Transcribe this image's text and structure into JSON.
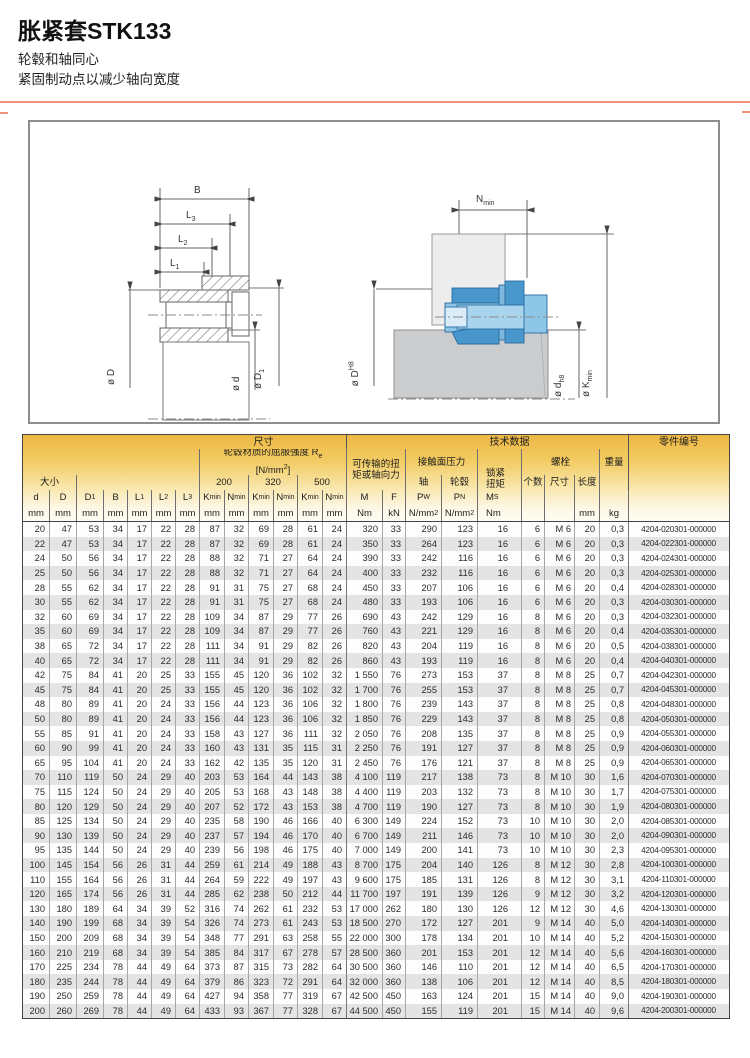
{
  "page": {
    "title": "胀紧套STK133",
    "subtitle_line1": "轮毂和轴同心",
    "subtitle_line2": "紧固制动点以减少轴向宽度",
    "accent_color": "#f0917c"
  },
  "diagram": {
    "left_labels": {
      "b": "B",
      "l3": "L_{3}",
      "l2": "L_{2}",
      "l1": "L_{1}",
      "dia_d_outer": "ø D",
      "dia_d_inner": "ø d",
      "dia_d1": "ø D_{1}"
    },
    "right_labels": {
      "n_min": "N_{min}",
      "dia_dh8_hub": "ø D^{H8}",
      "dia_dh8_shaft": "ø d_{h8}",
      "dia_kmin": "ø K_{min}"
    }
  },
  "table": {
    "sections": {
      "size": "尺寸",
      "tech": "技术数据",
      "part_no": "零件编号"
    },
    "groups": {
      "size_label": "大小",
      "yield_title": "轮毂材质的屈服强度 R_{e}",
      "yield_unit": "[N/mm^{2}]",
      "yield_200": "200",
      "yield_320": "320",
      "yield_500": "500",
      "torque_line1": "可传输的扭",
      "torque_line2": "矩或轴向力",
      "pressure": "接触面压力",
      "pressure_shaft": "轴",
      "pressure_hub": "轮毂",
      "locking_line1": "锁紧",
      "locking_line2": "扭矩",
      "bolts": "螺栓",
      "bolt_count": "个数",
      "bolt_size": "尺寸",
      "bolt_length": "长度",
      "weight": "重量"
    },
    "symbols": [
      "d",
      "D",
      "D_{1}",
      "B",
      "L_{1}",
      "L_{2}",
      "L_{3}",
      "K_{min}",
      "N_{min}",
      "K_{min}",
      "N_{min}",
      "K_{min}",
      "N_{min}",
      "M",
      "F",
      "P_{W}",
      "P_{N}",
      "M_{S}",
      "",
      "",
      "",
      "",
      ""
    ],
    "units": [
      "mm",
      "mm",
      "mm",
      "mm",
      "mm",
      "mm",
      "mm",
      "mm",
      "mm",
      "mm",
      "mm",
      "mm",
      "mm",
      "Nm",
      "kN",
      "N/mm^{2}",
      "N/mm^{2}",
      "Nm",
      "",
      "",
      "mm",
      "kg",
      ""
    ],
    "rows": [
      [
        "20",
        "47",
        "53",
        "34",
        "17",
        "22",
        "28",
        "87",
        "32",
        "69",
        "28",
        "61",
        "24",
        "320",
        "33",
        "290",
        "123",
        "16",
        "6",
        "M 6",
        "20",
        "0,3",
        "4204-020301-000000"
      ],
      [
        "22",
        "47",
        "53",
        "34",
        "17",
        "22",
        "28",
        "87",
        "32",
        "69",
        "28",
        "61",
        "24",
        "350",
        "33",
        "264",
        "123",
        "16",
        "6",
        "M 6",
        "20",
        "0,3",
        "4204-022301-000000"
      ],
      [
        "24",
        "50",
        "56",
        "34",
        "17",
        "22",
        "28",
        "88",
        "32",
        "71",
        "27",
        "64",
        "24",
        "390",
        "33",
        "242",
        "116",
        "16",
        "6",
        "M 6",
        "20",
        "0,3",
        "4204-024301-000000"
      ],
      [
        "25",
        "50",
        "56",
        "34",
        "17",
        "22",
        "28",
        "88",
        "32",
        "71",
        "27",
        "64",
        "24",
        "400",
        "33",
        "232",
        "116",
        "16",
        "6",
        "M 6",
        "20",
        "0,3",
        "4204-025301-000000"
      ],
      [
        "28",
        "55",
        "62",
        "34",
        "17",
        "22",
        "28",
        "91",
        "31",
        "75",
        "27",
        "68",
        "24",
        "450",
        "33",
        "207",
        "106",
        "16",
        "6",
        "M 6",
        "20",
        "0,4",
        "4204-028301-000000"
      ],
      [
        "30",
        "55",
        "62",
        "34",
        "17",
        "22",
        "28",
        "91",
        "31",
        "75",
        "27",
        "68",
        "24",
        "480",
        "33",
        "193",
        "106",
        "16",
        "6",
        "M 6",
        "20",
        "0,3",
        "4204-030301-000000"
      ],
      [
        "32",
        "60",
        "69",
        "34",
        "17",
        "22",
        "28",
        "109",
        "34",
        "87",
        "29",
        "77",
        "26",
        "690",
        "43",
        "242",
        "129",
        "16",
        "8",
        "M 6",
        "20",
        "0,3",
        "4204-032301-000000"
      ],
      [
        "35",
        "60",
        "69",
        "34",
        "17",
        "22",
        "28",
        "109",
        "34",
        "87",
        "29",
        "77",
        "26",
        "760",
        "43",
        "221",
        "129",
        "16",
        "8",
        "M 6",
        "20",
        "0,4",
        "4204-035301-000000"
      ],
      [
        "38",
        "65",
        "72",
        "34",
        "17",
        "22",
        "28",
        "111",
        "34",
        "91",
        "29",
        "82",
        "26",
        "820",
        "43",
        "204",
        "119",
        "16",
        "8",
        "M 6",
        "20",
        "0,5",
        "4204-038301-000000"
      ],
      [
        "40",
        "65",
        "72",
        "34",
        "17",
        "22",
        "28",
        "111",
        "34",
        "91",
        "29",
        "82",
        "26",
        "860",
        "43",
        "193",
        "119",
        "16",
        "8",
        "M 6",
        "20",
        "0,4",
        "4204-040301-000000"
      ],
      [
        "42",
        "75",
        "84",
        "41",
        "20",
        "25",
        "33",
        "155",
        "45",
        "120",
        "36",
        "102",
        "32",
        "1 550",
        "76",
        "273",
        "153",
        "37",
        "8",
        "M 8",
        "25",
        "0,7",
        "4204-042301-000000"
      ],
      [
        "45",
        "75",
        "84",
        "41",
        "20",
        "25",
        "33",
        "155",
        "45",
        "120",
        "36",
        "102",
        "32",
        "1 700",
        "76",
        "255",
        "153",
        "37",
        "8",
        "M 8",
        "25",
        "0,7",
        "4204-045301-000000"
      ],
      [
        "48",
        "80",
        "89",
        "41",
        "20",
        "24",
        "33",
        "156",
        "44",
        "123",
        "36",
        "106",
        "32",
        "1 800",
        "76",
        "239",
        "143",
        "37",
        "8",
        "M 8",
        "25",
        "0,8",
        "4204-048301-000000"
      ],
      [
        "50",
        "80",
        "89",
        "41",
        "20",
        "24",
        "33",
        "156",
        "44",
        "123",
        "36",
        "106",
        "32",
        "1 850",
        "76",
        "229",
        "143",
        "37",
        "8",
        "M 8",
        "25",
        "0,8",
        "4204-050301-000000"
      ],
      [
        "55",
        "85",
        "91",
        "41",
        "20",
        "24",
        "33",
        "158",
        "43",
        "127",
        "36",
        "111",
        "32",
        "2 050",
        "76",
        "208",
        "135",
        "37",
        "8",
        "M 8",
        "25",
        "0,9",
        "4204-055301-000000"
      ],
      [
        "60",
        "90",
        "99",
        "41",
        "20",
        "24",
        "33",
        "160",
        "43",
        "131",
        "35",
        "115",
        "31",
        "2 250",
        "76",
        "191",
        "127",
        "37",
        "8",
        "M 8",
        "25",
        "0,9",
        "4204-060301-000000"
      ],
      [
        "65",
        "95",
        "104",
        "41",
        "20",
        "24",
        "33",
        "162",
        "42",
        "135",
        "35",
        "120",
        "31",
        "2 450",
        "76",
        "176",
        "121",
        "37",
        "8",
        "M 8",
        "25",
        "0,9",
        "4204-065301-000000"
      ],
      [
        "70",
        "110",
        "119",
        "50",
        "24",
        "29",
        "40",
        "203",
        "53",
        "164",
        "44",
        "143",
        "38",
        "4 100",
        "119",
        "217",
        "138",
        "73",
        "8",
        "M 10",
        "30",
        "1,6",
        "4204-070301-000000"
      ],
      [
        "75",
        "115",
        "124",
        "50",
        "24",
        "29",
        "40",
        "205",
        "53",
        "168",
        "43",
        "148",
        "38",
        "4 400",
        "119",
        "203",
        "132",
        "73",
        "8",
        "M 10",
        "30",
        "1,7",
        "4204-075301-000000"
      ],
      [
        "80",
        "120",
        "129",
        "50",
        "24",
        "29",
        "40",
        "207",
        "52",
        "172",
        "43",
        "153",
        "38",
        "4 700",
        "119",
        "190",
        "127",
        "73",
        "8",
        "M 10",
        "30",
        "1,9",
        "4204-080301-000000"
      ],
      [
        "85",
        "125",
        "134",
        "50",
        "24",
        "29",
        "40",
        "235",
        "58",
        "190",
        "46",
        "166",
        "40",
        "6 300",
        "149",
        "224",
        "152",
        "73",
        "10",
        "M 10",
        "30",
        "2,0",
        "4204-085301-000000"
      ],
      [
        "90",
        "130",
        "139",
        "50",
        "24",
        "29",
        "40",
        "237",
        "57",
        "194",
        "46",
        "170",
        "40",
        "6 700",
        "149",
        "211",
        "146",
        "73",
        "10",
        "M 10",
        "30",
        "2,0",
        "4204-090301-000000"
      ],
      [
        "95",
        "135",
        "144",
        "50",
        "24",
        "29",
        "40",
        "239",
        "56",
        "198",
        "46",
        "175",
        "40",
        "7 000",
        "149",
        "200",
        "141",
        "73",
        "10",
        "M 10",
        "30",
        "2,3",
        "4204-095301-000000"
      ],
      [
        "100",
        "145",
        "154",
        "56",
        "26",
        "31",
        "44",
        "259",
        "61",
        "214",
        "49",
        "188",
        "43",
        "8 700",
        "175",
        "204",
        "140",
        "126",
        "8",
        "M 12",
        "30",
        "2,8",
        "4204-100301-000000"
      ],
      [
        "110",
        "155",
        "164",
        "56",
        "26",
        "31",
        "44",
        "264",
        "59",
        "222",
        "49",
        "197",
        "43",
        "9 600",
        "175",
        "185",
        "131",
        "126",
        "8",
        "M 12",
        "30",
        "3,1",
        "4204-110301-000000"
      ],
      [
        "120",
        "165",
        "174",
        "56",
        "26",
        "31",
        "44",
        "285",
        "62",
        "238",
        "50",
        "212",
        "44",
        "11 700",
        "197",
        "191",
        "139",
        "126",
        "9",
        "M 12",
        "30",
        "3,2",
        "4204-120301-000000"
      ],
      [
        "130",
        "180",
        "189",
        "64",
        "34",
        "39",
        "52",
        "316",
        "74",
        "262",
        "61",
        "232",
        "53",
        "17 000",
        "262",
        "180",
        "130",
        "126",
        "12",
        "M 12",
        "30",
        "4,6",
        "4204-130301-000000"
      ],
      [
        "140",
        "190",
        "199",
        "68",
        "34",
        "39",
        "54",
        "326",
        "74",
        "273",
        "61",
        "243",
        "53",
        "18 500",
        "270",
        "172",
        "127",
        "201",
        "9",
        "M 14",
        "40",
        "5,0",
        "4204-140301-000000"
      ],
      [
        "150",
        "200",
        "209",
        "68",
        "34",
        "39",
        "54",
        "348",
        "77",
        "291",
        "63",
        "258",
        "55",
        "22 000",
        "300",
        "178",
        "134",
        "201",
        "10",
        "M 14",
        "40",
        "5,2",
        "4204-150301-000000"
      ],
      [
        "160",
        "210",
        "219",
        "68",
        "34",
        "39",
        "54",
        "385",
        "84",
        "317",
        "67",
        "278",
        "57",
        "28 500",
        "360",
        "201",
        "153",
        "201",
        "12",
        "M 14",
        "40",
        "5,6",
        "4204-160301-000000"
      ],
      [
        "170",
        "225",
        "234",
        "78",
        "44",
        "49",
        "64",
        "373",
        "87",
        "315",
        "73",
        "282",
        "64",
        "30 500",
        "360",
        "146",
        "110",
        "201",
        "12",
        "M 14",
        "40",
        "6,5",
        "4204-170301-000000"
      ],
      [
        "180",
        "235",
        "244",
        "78",
        "44",
        "49",
        "64",
        "379",
        "86",
        "323",
        "72",
        "291",
        "64",
        "32 000",
        "360",
        "138",
        "106",
        "201",
        "12",
        "M 14",
        "40",
        "8,5",
        "4204-180301-000000"
      ],
      [
        "190",
        "250",
        "259",
        "78",
        "44",
        "49",
        "64",
        "427",
        "94",
        "358",
        "77",
        "319",
        "67",
        "42 500",
        "450",
        "163",
        "124",
        "201",
        "15",
        "M 14",
        "40",
        "9,0",
        "4204-190301-000000"
      ],
      [
        "200",
        "260",
        "269",
        "78",
        "44",
        "49",
        "64",
        "433",
        "93",
        "367",
        "77",
        "328",
        "67",
        "44 500",
        "450",
        "155",
        "119",
        "201",
        "15",
        "M 14",
        "40",
        "9,6",
        "4204-200301-000000"
      ]
    ]
  }
}
